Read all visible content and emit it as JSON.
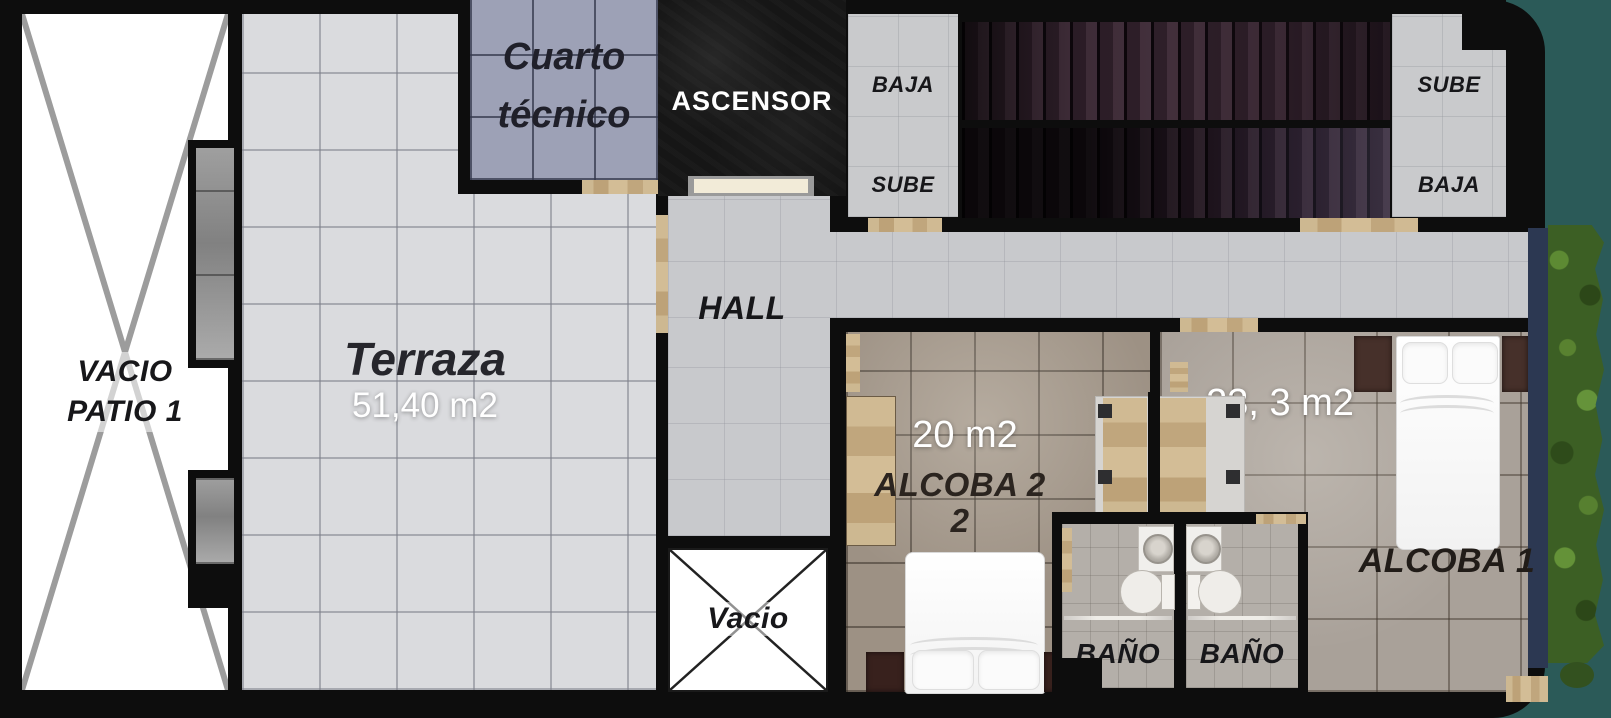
{
  "rooms": {
    "patio": {
      "line1": "VACIO",
      "line2": "PATIO 1"
    },
    "terraza": {
      "name": "Terraza",
      "area": "51,40 m2"
    },
    "cuarto_tecnico": {
      "line1": "Cuarto",
      "line2": "técnico"
    },
    "ascensor": {
      "label": "ASCENSOR"
    },
    "stairs": {
      "left_top": "BAJA",
      "left_bottom": "SUBE",
      "right_top": "SUBE",
      "right_bottom": "BAJA"
    },
    "hall": {
      "label": "HALL"
    },
    "vacio": {
      "label": "Vacio"
    },
    "alcoba2": {
      "area": "20 m2",
      "name": "ALCOBA 2",
      "name_wrap": "2"
    },
    "alcoba1": {
      "area": "23, 3 m2",
      "name": "ALCOBA 1"
    },
    "bano_left": {
      "label": "BAÑO"
    },
    "bano_right": {
      "label": "BAÑO"
    }
  },
  "colors": {
    "background_teal": "#2b5a58",
    "wall_black": "#0d0d0d",
    "terraza_tile": "#dadbde",
    "tech_room_tile": "#9da1b6",
    "hall_tile": "#c8c9cc",
    "alcoba2_floor": "#9d9184",
    "alcoba1_floor": "#a9a199",
    "bath_floor": "#b4afa9",
    "wood_threshold": "#c9b48c",
    "stair_tread": "#2e1f29",
    "plants_green": "#3c5f24",
    "window_wall_navy": "#2c3852",
    "elevator_door_cream": "#f2ebd8"
  }
}
